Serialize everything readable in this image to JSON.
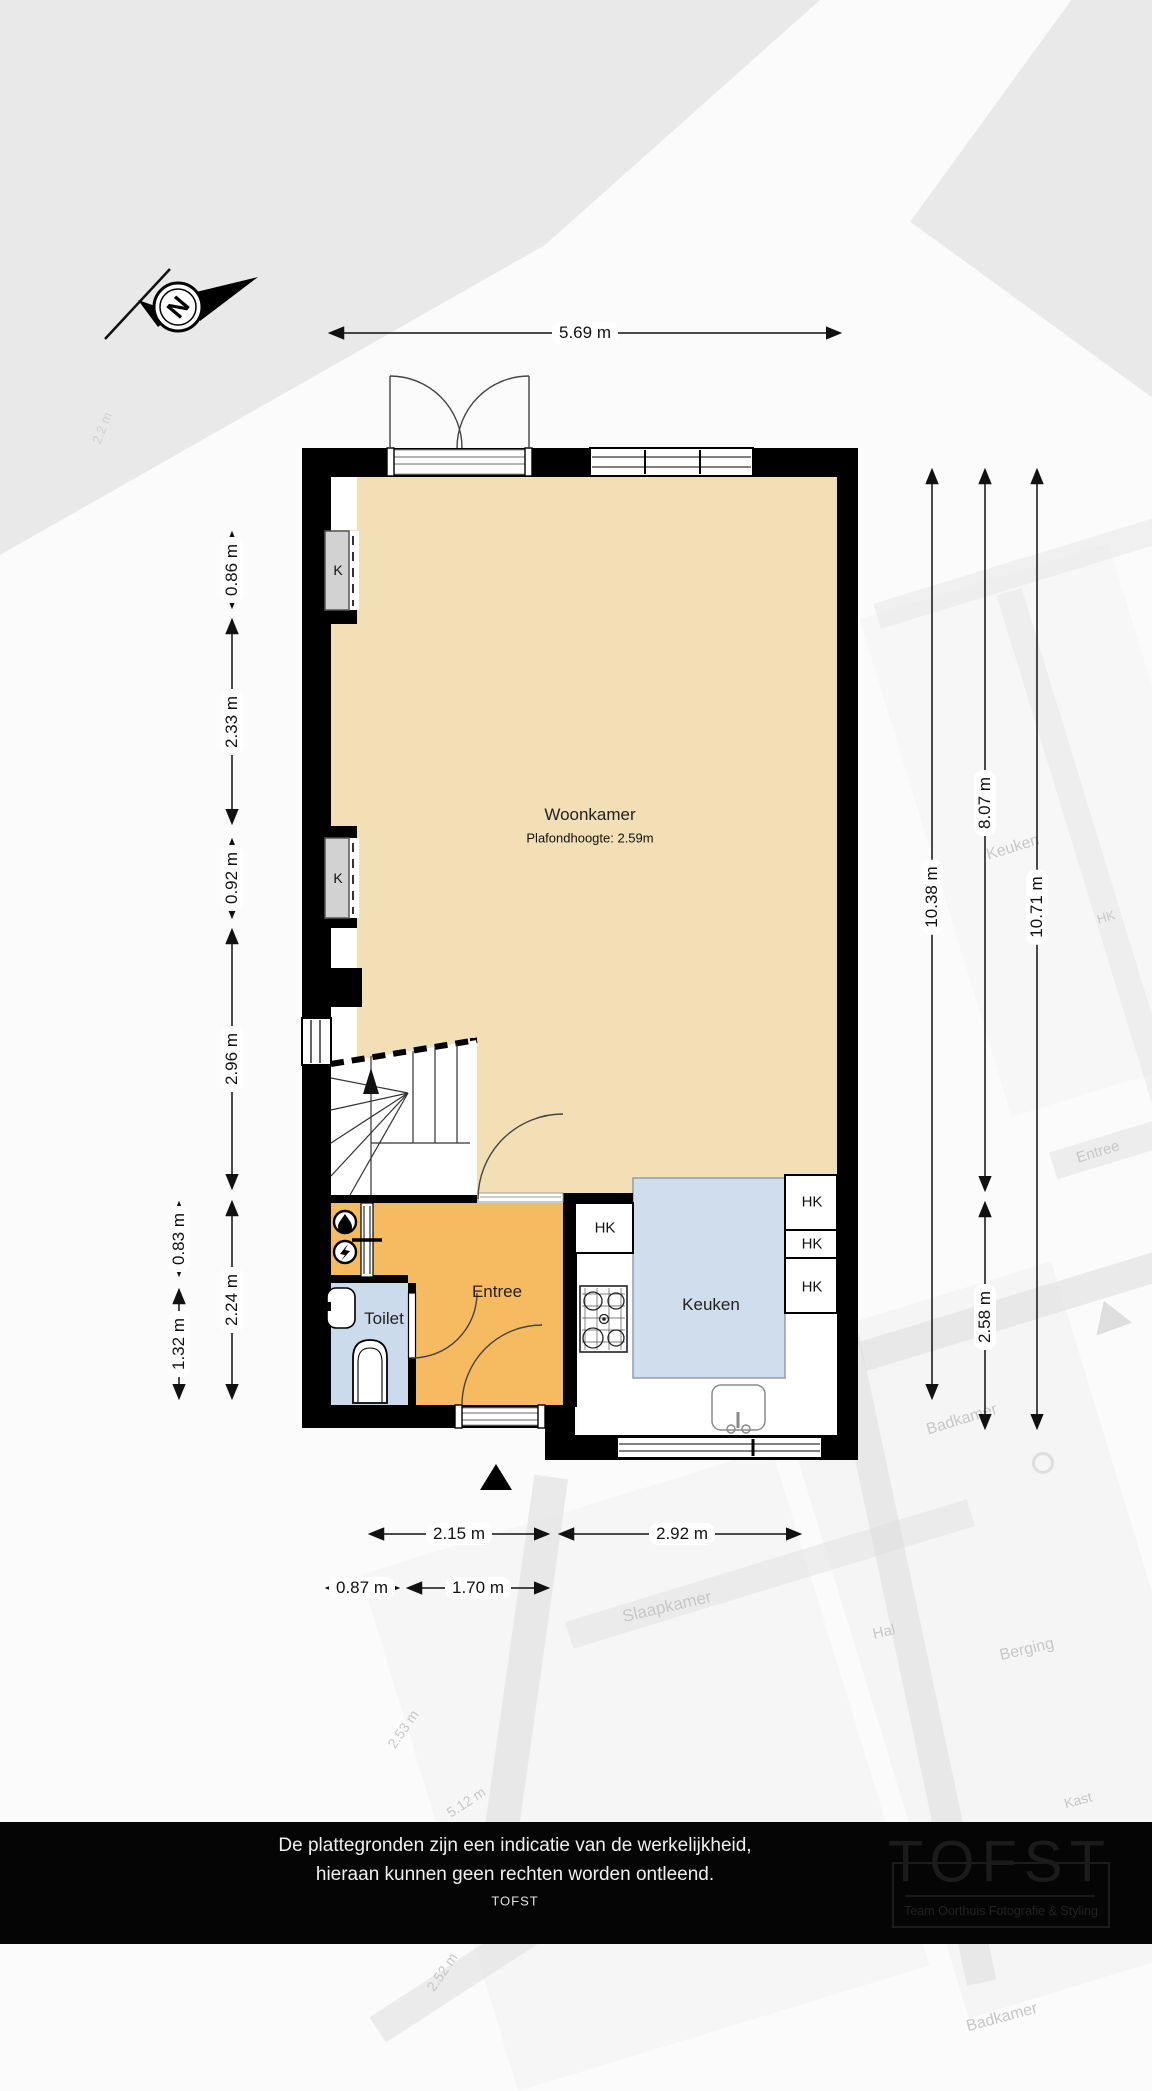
{
  "compass": {
    "letter": "N"
  },
  "rooms": {
    "woonkamer": {
      "name": "Woonkamer",
      "ceiling": "Plafondhoogte: 2.59m"
    },
    "entree": {
      "name": "Entree"
    },
    "toilet": {
      "name": "Toilet"
    },
    "keuken": {
      "name": "Keuken"
    },
    "closet1": "K",
    "closet2": "K",
    "hk_left": "HK",
    "hk_right1": "HK",
    "hk_right2": "HK",
    "hk_right3": "HK"
  },
  "dimensions": {
    "top": "5.69 m",
    "left_inner1": "0.86 m",
    "left_inner2": "2.33 m",
    "left_inner3": "0.92 m",
    "left_inner4": "2.96 m",
    "left_inner5": "2.24 m",
    "left_outer1": "0.83 m",
    "left_outer2": "1.32 m",
    "right1": "10.38 m",
    "right2": "8.07 m",
    "right3": "10.71 m",
    "right4": "2.58 m",
    "bottom1": "2.15 m",
    "bottom2": "2.92 m",
    "bottom3": "0.87 m",
    "bottom4": "1.70 m"
  },
  "watermark": {
    "labels": [
      "Keuken",
      "HK",
      "Entree",
      "Badkamer",
      "Slaapkamer",
      "Hal",
      "Berging",
      "Kast",
      "2.53 m",
      "5.12 m",
      "2.52 m",
      "Badkamer",
      "2.2 m"
    ]
  },
  "footer": {
    "line1": "De plattegronden zijn een indicatie van de werkelijkheid,",
    "line2": "hieraan kunnen geen rechten worden ontleend.",
    "line3": "TOFST",
    "logo_title": "TOFST",
    "logo_subtitle": "Team Oorthuis Fotografie & Styling"
  },
  "colors": {
    "wall": "#000000",
    "woonkamer_floor": "#F2DFB5",
    "entree_floor": "#F6BA60",
    "toilet_floor": "#CCDBEB",
    "keuken_floor": "#CFDDEC",
    "closet": "#D2D2D2"
  }
}
